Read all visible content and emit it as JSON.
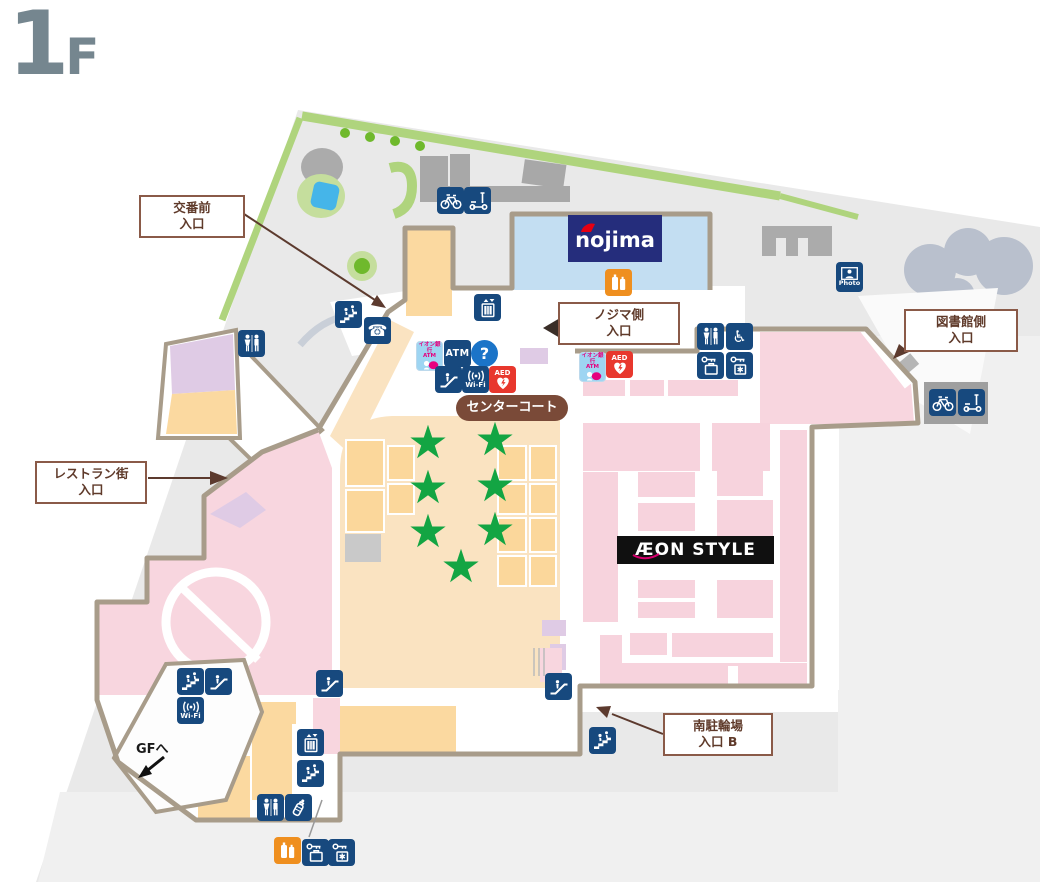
{
  "floor_label": {
    "number": "1",
    "suffix": "F"
  },
  "entrance_labels": {
    "koban": {
      "line1": "交番前",
      "line2": "入口"
    },
    "nojima_side": {
      "line1": "ノジマ側",
      "line2": "入口"
    },
    "library_side": {
      "line1": "図書館側",
      "line2": "入口"
    },
    "restaurant_street": {
      "line1": "レストラン街",
      "line2": "入口"
    },
    "south_bicycle": {
      "line1": "南駐輪場",
      "line2": "入口 B"
    }
  },
  "area_labels": {
    "center_court": "センターコート",
    "to_gf": "GFへ"
  },
  "stores": {
    "nojima": "nojima",
    "aeon_style": "ÆON STYLE"
  },
  "icon_text": {
    "atm": "ATM",
    "wifi": "Wi-Fi",
    "aed": "AED",
    "photo": "Photo",
    "info": "?",
    "aeon_bank_atm_line1": "イオン銀行",
    "aeon_bank_atm_line2": "ATM",
    "star": "★"
  },
  "colors": {
    "site_gray": "#E9E9E9",
    "light_gray": "#F0F0F0",
    "border_taupe": "#A89C8A",
    "pink": "#F8D6DF",
    "tan": "#FAE3C1",
    "orange_block": "#FBD9A0",
    "purple": "#DFCBE5",
    "nojima_blue": "#C3DEF2",
    "nojima_navy": "#252D7C",
    "icon_navy": "#17497E",
    "label_brown": "#8A5A48",
    "star_green": "#13A543",
    "aed_red": "#E8372D",
    "info_blue": "#1B74C8",
    "vending_orange": "#EF8F1F",
    "green_strip": "#AFD47D",
    "water_blue": "#45B5E9"
  },
  "icons": [
    {
      "name": "north-bicycle-parking",
      "type": "bicycle",
      "x": 437,
      "y": 187
    },
    {
      "name": "north-scooter-parking",
      "type": "scooter",
      "x": 464,
      "y": 187
    },
    {
      "name": "elevator-north",
      "type": "elevator",
      "x": 474,
      "y": 294
    },
    {
      "name": "stairs-northwest",
      "type": "stairs",
      "x": 335,
      "y": 301
    },
    {
      "name": "public-phone",
      "type": "phone",
      "x": 364,
      "y": 317
    },
    {
      "name": "toilet-northwest",
      "type": "toilet",
      "x": 238,
      "y": 330
    },
    {
      "name": "aeon-bank-atm-center",
      "type": "aeon_atm",
      "x": 416,
      "y": 341
    },
    {
      "name": "atm-center",
      "type": "atm",
      "x": 444,
      "y": 340
    },
    {
      "name": "information",
      "type": "info",
      "x": 471,
      "y": 340
    },
    {
      "name": "escalator-center",
      "type": "escalator",
      "x": 435,
      "y": 366
    },
    {
      "name": "wifi-center",
      "type": "wifi",
      "x": 462,
      "y": 366
    },
    {
      "name": "aed-center",
      "type": "aed",
      "x": 489,
      "y": 366
    },
    {
      "name": "vending-nojima",
      "type": "vending",
      "x": 605,
      "y": 269
    },
    {
      "name": "aeon-bank-atm-east",
      "type": "aeon_atm",
      "x": 579,
      "y": 352
    },
    {
      "name": "aed-east",
      "type": "aed",
      "x": 606,
      "y": 351
    },
    {
      "name": "toilet-east",
      "type": "toilet",
      "x": 697,
      "y": 323
    },
    {
      "name": "accessible-toilet-east",
      "type": "accessible",
      "x": 726,
      "y": 323
    },
    {
      "name": "coin-locker-east",
      "type": "coin_locker",
      "x": 697,
      "y": 352
    },
    {
      "name": "cold-locker-east",
      "type": "cold_locker",
      "x": 726,
      "y": 352
    },
    {
      "name": "photo-spot",
      "type": "photo",
      "x": 836,
      "y": 262
    },
    {
      "name": "east-bicycle-parking",
      "type": "bicycle",
      "x": 929,
      "y": 389
    },
    {
      "name": "east-scooter-parking",
      "type": "scooter",
      "x": 958,
      "y": 389
    },
    {
      "name": "stairs-southwest",
      "type": "stairs",
      "x": 177,
      "y": 668
    },
    {
      "name": "escalator-southwest",
      "type": "escalator",
      "x": 205,
      "y": 668
    },
    {
      "name": "wifi-southwest",
      "type": "wifi",
      "x": 177,
      "y": 697
    },
    {
      "name": "escalator-midsouth",
      "type": "escalator",
      "x": 316,
      "y": 670
    },
    {
      "name": "elevator-south",
      "type": "elevator",
      "x": 297,
      "y": 729
    },
    {
      "name": "stairs-south",
      "type": "stairs",
      "x": 297,
      "y": 760
    },
    {
      "name": "toilet-south",
      "type": "toilet",
      "x": 257,
      "y": 794
    },
    {
      "name": "baby-room",
      "type": "baby",
      "x": 285,
      "y": 794
    },
    {
      "name": "vending-south",
      "type": "vending",
      "x": 274,
      "y": 837
    },
    {
      "name": "coin-locker-south",
      "type": "coin_locker",
      "x": 302,
      "y": 839
    },
    {
      "name": "cold-locker-south",
      "type": "cold_locker",
      "x": 328,
      "y": 839
    },
    {
      "name": "escalator-southeast",
      "type": "escalator",
      "x": 545,
      "y": 673
    },
    {
      "name": "stairs-south-bicycle",
      "type": "stairs",
      "x": 589,
      "y": 727
    }
  ],
  "stars": [
    {
      "x": 428,
      "y": 443
    },
    {
      "x": 495,
      "y": 440
    },
    {
      "x": 428,
      "y": 488
    },
    {
      "x": 495,
      "y": 486
    },
    {
      "x": 428,
      "y": 532
    },
    {
      "x": 495,
      "y": 530
    },
    {
      "x": 461,
      "y": 567
    }
  ]
}
